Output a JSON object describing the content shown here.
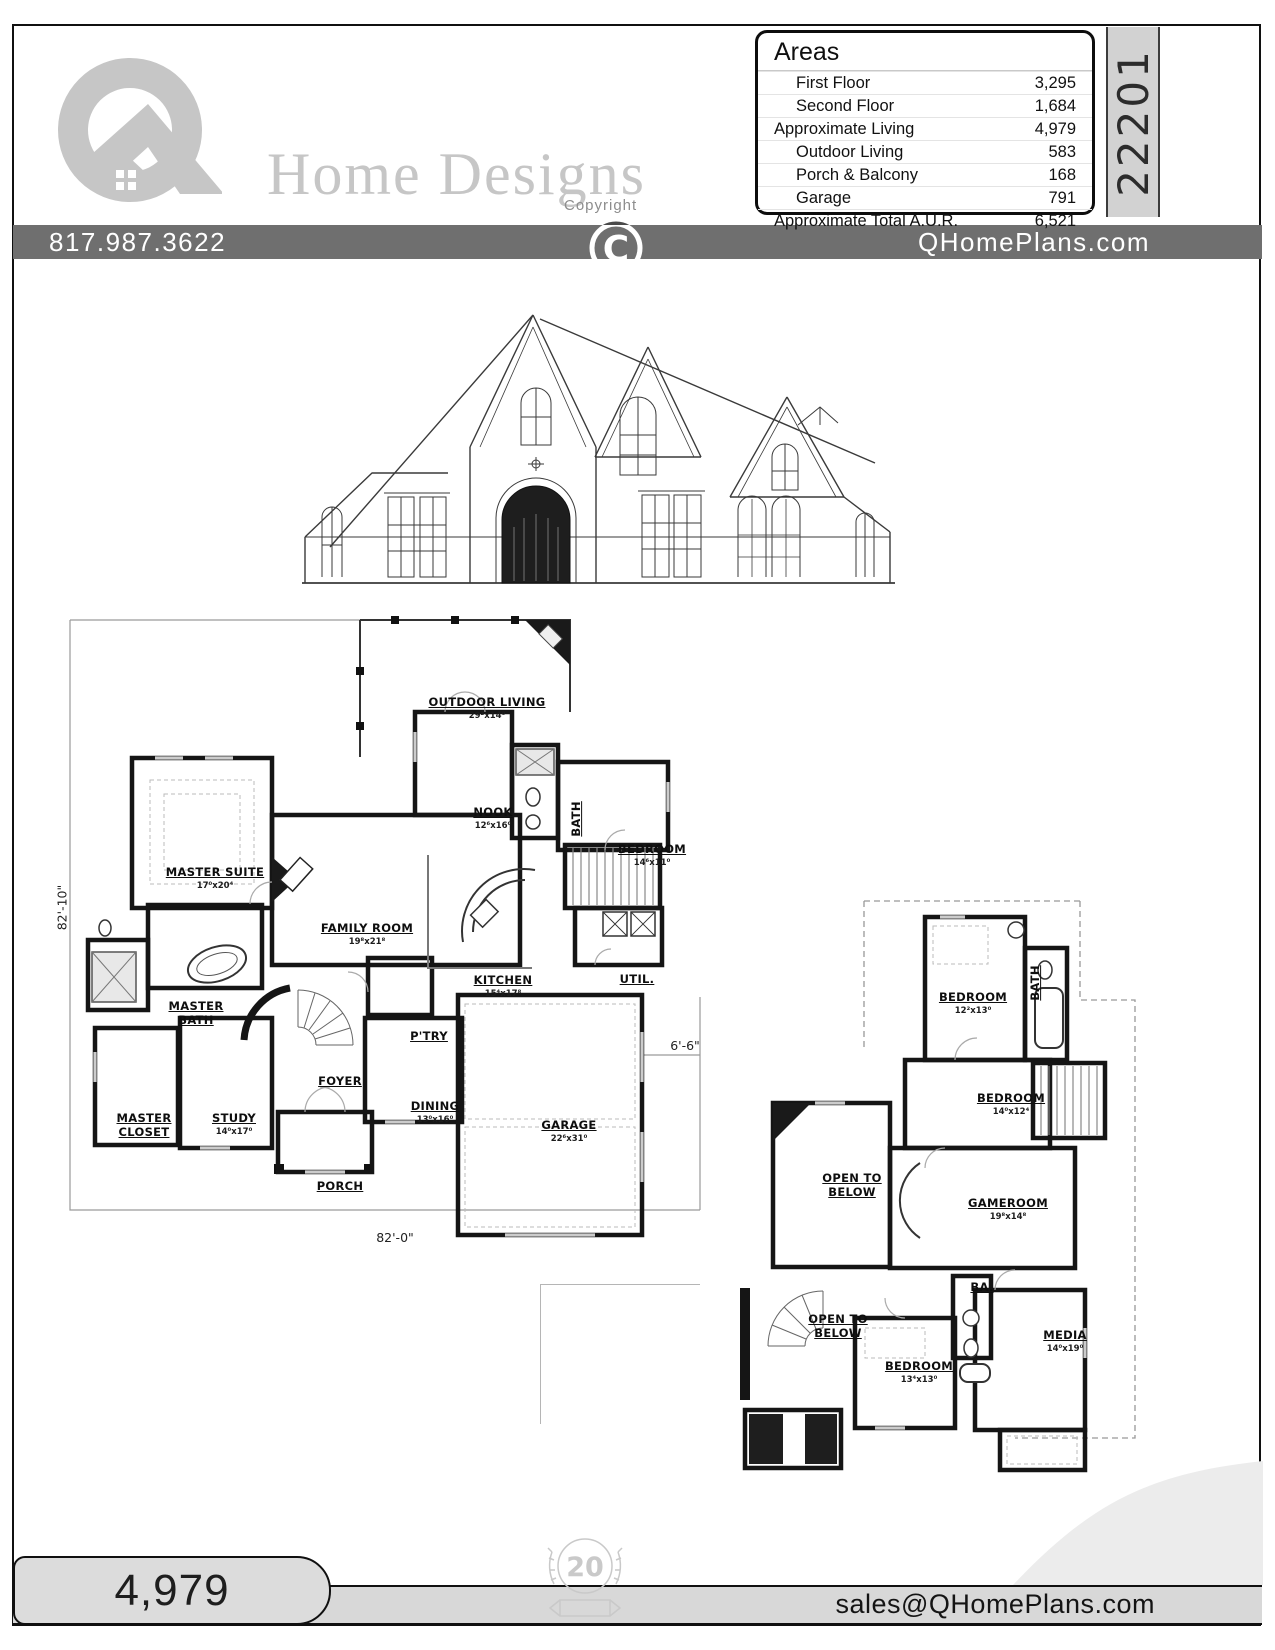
{
  "sheet": {
    "phone": "817.987.3622",
    "website": "QHomePlans.com",
    "email": "sales@QHomePlans.com",
    "copyright_label": "Copyright",
    "copyright_symbol": "C",
    "plan_number": "22201",
    "footer_sqft": "4,979",
    "anniversary_badge": "20"
  },
  "logo": {
    "name": "Home Designs"
  },
  "areas_table": {
    "title": "Areas",
    "rows": [
      {
        "label": "First Floor",
        "value": "3,295"
      },
      {
        "label": "Second Floor",
        "value": "1,684"
      },
      {
        "label": "Approximate Living",
        "value": "4,979"
      },
      {
        "label": "Outdoor Living",
        "value": "583"
      },
      {
        "label": "Porch & Balcony",
        "value": "168"
      },
      {
        "label": "Garage",
        "value": "791"
      },
      {
        "label": "Approximate Total A.U.R.",
        "value": "6,521"
      }
    ]
  },
  "first_floor": {
    "rooms": [
      {
        "name": "OUTDOOR LIVING",
        "dims": "29²x14⁰"
      },
      {
        "name": "NOOK",
        "dims": "12⁶x16⁰"
      },
      {
        "name": "BATH",
        "dims": ""
      },
      {
        "name": "BEDROOM",
        "dims": "14⁶x11⁰"
      },
      {
        "name": "MASTER SUITE",
        "dims": "17⁰x20⁴"
      },
      {
        "name": "FAMILY ROOM",
        "dims": "19⁸x21⁸"
      },
      {
        "name": "KITCHEN",
        "dims": "15⁴x17⁸"
      },
      {
        "name": "UTIL.",
        "dims": ""
      },
      {
        "name": "MASTER BATH",
        "dims": ""
      },
      {
        "name": "P'TRY",
        "dims": ""
      },
      {
        "name": "FOYER",
        "dims": ""
      },
      {
        "name": "MASTER CLOSET",
        "dims": ""
      },
      {
        "name": "STUDY",
        "dims": "14⁰x17⁰"
      },
      {
        "name": "DINING",
        "dims": "13⁰x16⁰"
      },
      {
        "name": "GARAGE",
        "dims": "22⁶x31⁰"
      },
      {
        "name": "PORCH",
        "dims": ""
      }
    ],
    "dim_left": "82'-10\"",
    "dim_bottom": "82'-0\"",
    "dim_side": "6'-6\""
  },
  "second_floor": {
    "rooms": [
      {
        "name": "BEDROOM",
        "dims": "12²x13⁰"
      },
      {
        "name": "BATH",
        "dims": ""
      },
      {
        "name": "BEDROOM",
        "dims": "14⁰x12⁴"
      },
      {
        "name": "OPEN TO BELOW",
        "dims": ""
      },
      {
        "name": "GAMEROOM",
        "dims": "19⁸x14⁸"
      },
      {
        "name": "BA.",
        "dims": ""
      },
      {
        "name": "OPEN TO BELOW",
        "dims": ""
      },
      {
        "name": "BEDROOM",
        "dims": "13⁴x13⁰"
      },
      {
        "name": "MEDIA",
        "dims": "14⁰x19⁰"
      }
    ]
  }
}
